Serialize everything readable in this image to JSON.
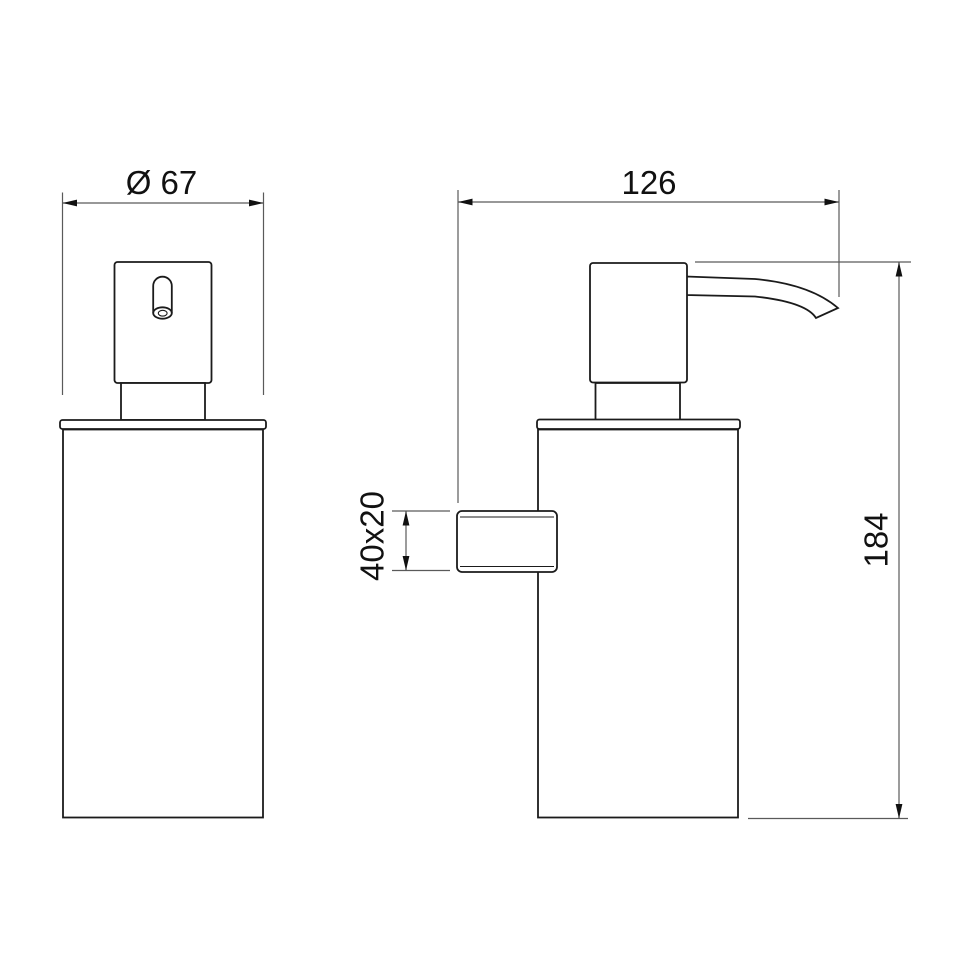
{
  "colors": {
    "background": "#ffffff",
    "object_line": "#1b1b1b",
    "dimension_line": "#5a5a5a",
    "label_text": "#111111"
  },
  "front_view": {
    "diameter_label": "Ø 67",
    "diameter_value": 67
  },
  "side_view": {
    "depth_label": "126",
    "depth_value": 126,
    "bracket_label": "40x20",
    "bracket_width": 40,
    "bracket_height": 20,
    "height_label": "184",
    "height_value": 184
  }
}
